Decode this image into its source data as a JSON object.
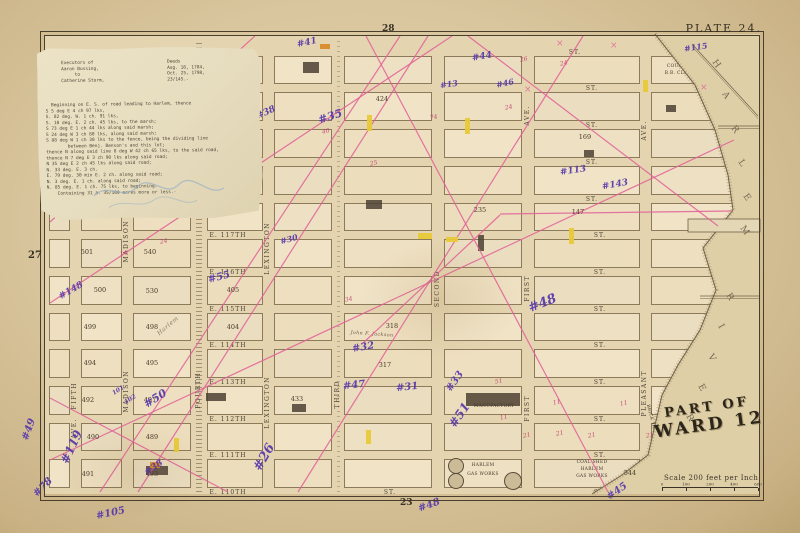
{
  "plate_label": "PLATE 24.",
  "margins": {
    "left": "27",
    "top": "28",
    "bottom": "23"
  },
  "ward_title": {
    "line1": "PART OF",
    "line2": "WARD 12"
  },
  "scale": {
    "label": "Scale 200 feet per Inch",
    "ticks": [
      "0",
      "100",
      "200",
      "400",
      "600"
    ]
  },
  "river": {
    "upper_letters": "HARLEM",
    "lower_letters": "RIVER"
  },
  "colors": {
    "paper": "#d9c69e",
    "block": "#eee0c2",
    "pink_line": "#e25f98",
    "purple_ink": "#5636ab",
    "red_ink": "#c23b6e",
    "yellow_lot": "#e8c938",
    "water": "#decfa7"
  },
  "deed_note": {
    "parties": [
      "Executors of",
      "Aaron Bussing,",
      "     to",
      "Catherine Storm,"
    ],
    "deeds": [
      "Deeds",
      "Aug. 18, 1784,",
      "Oct. 25, 1798,",
      "23/145.-"
    ],
    "body": [
      "  Beginning on E. S. of road leading to Harlem, thence",
      "S 5 deg E 4 ch 97 lks,",
      "S. 82 deg. W. 1 ch. 91 lks,",
      "S. 10 deg. E. 2 ch. 45 lks, to the marsh;",
      "S 73 deg E 1 ch 44 lks along said marsh;",
      "S 24 deg W 3 ch 80 lks, along said marsh;",
      "S 88 deg W 1 ch 30 lks to the fence, being the dividing line",
      "        between Benj. Benson's and this lot;",
      "thence N along said line 8 deg W 42 ch 65 lks, to the said road,",
      "thence N 7 deg E 3 ch 90 lks along said road;",
      "N 35 deg E 2 ch 45 lks along said road;",
      "N. 33 deg. E. 3 ch.",
      "E. 79 deg. 30 min E. 2 ch. along said road;",
      "N. 3 deg. E. 1 ch. along said road;",
      "N. 85 deg. E. 1 ch. 75 lks, to beginning.",
      "    Containing 31 a. 35/100 acres more or less.-"
    ]
  },
  "avenues": [
    {
      "x": 75,
      "w": 9,
      "labels": [
        {
          "t": "FIFTH",
          "y": 412
        },
        {
          "t": "AVE.",
          "y": 448
        }
      ]
    },
    {
      "x": 127,
      "w": 9,
      "labels": [
        {
          "t": "MADISON",
          "y": 250
        },
        {
          "t": "MADISON",
          "y": 400
        }
      ]
    },
    {
      "x": 199,
      "w": 14,
      "rail": true,
      "labels": [
        {
          "t": "FOURTH",
          "y": 402
        }
      ]
    },
    {
      "x": 268,
      "w": 9,
      "labels": [
        {
          "t": "LEXINGTON",
          "y": 252
        },
        {
          "t": "LEXINGTON",
          "y": 406
        }
      ]
    },
    {
      "x": 338,
      "w": 10,
      "el": true,
      "labels": [
        {
          "t": "THIRD",
          "y": 410
        }
      ]
    },
    {
      "x": 438,
      "w": 10,
      "labels": [
        {
          "t": "SECOND",
          "y": 300
        }
      ]
    },
    {
      "x": 528,
      "w": 10,
      "labels": [
        {
          "t": "FIRST",
          "y": 305
        },
        {
          "t": "AVE.",
          "y": 135
        },
        {
          "t": "FIRST",
          "y": 425
        }
      ]
    },
    {
      "x": 645,
      "w": 9,
      "labels": [
        {
          "t": "PLEASANT",
          "y": 400
        },
        {
          "t": "AVE.",
          "y": 150
        }
      ]
    }
  ],
  "streets": {
    "ys": [
      52,
      88,
      125,
      162,
      199,
      235,
      272,
      309,
      345,
      382,
      419,
      455,
      492
    ],
    "labels": [
      {
        "x": 228,
        "y": 235,
        "t": "E. 117TH"
      },
      {
        "x": 228,
        "y": 272,
        "t": "E. 116TH"
      },
      {
        "x": 228,
        "y": 309,
        "t": "E. 115TH"
      },
      {
        "x": 228,
        "y": 345,
        "t": "E. 114TH"
      },
      {
        "x": 228,
        "y": 382,
        "t": "E. 113TH"
      },
      {
        "x": 228,
        "y": 419,
        "t": "E. 112TH"
      },
      {
        "x": 228,
        "y": 455,
        "t": "E. 111TH"
      },
      {
        "x": 228,
        "y": 492,
        "t": "E. 110TH"
      },
      {
        "x": 600,
        "y": 235,
        "t": "ST."
      },
      {
        "x": 600,
        "y": 272,
        "t": "ST."
      },
      {
        "x": 600,
        "y": 309,
        "t": "ST."
      },
      {
        "x": 600,
        "y": 345,
        "t": "ST."
      },
      {
        "x": 600,
        "y": 382,
        "t": "ST."
      },
      {
        "x": 600,
        "y": 419,
        "t": "ST."
      },
      {
        "x": 600,
        "y": 455,
        "t": "ST."
      },
      {
        "x": 600,
        "y": 492,
        "t": "ST."
      },
      {
        "x": 592,
        "y": 88,
        "t": "ST."
      },
      {
        "x": 592,
        "y": 125,
        "t": "ST."
      },
      {
        "x": 592,
        "y": 162,
        "t": "ST."
      },
      {
        "x": 592,
        "y": 199,
        "t": "ST."
      },
      {
        "x": 575,
        "y": 52,
        "t": "ST."
      },
      {
        "x": 390,
        "y": 492,
        "t": "ST."
      }
    ]
  },
  "block_numbers": [
    {
      "x": 87,
      "y": 252,
      "t": "501"
    },
    {
      "x": 150,
      "y": 252,
      "t": "540"
    },
    {
      "x": 100,
      "y": 290,
      "t": "500"
    },
    {
      "x": 152,
      "y": 291,
      "t": "530"
    },
    {
      "x": 90,
      "y": 327,
      "t": "499"
    },
    {
      "x": 152,
      "y": 327,
      "t": "498"
    },
    {
      "x": 90,
      "y": 363,
      "t": "494"
    },
    {
      "x": 152,
      "y": 363,
      "t": "495"
    },
    {
      "x": 88,
      "y": 400,
      "t": "492"
    },
    {
      "x": 150,
      "y": 400,
      "t": "497"
    },
    {
      "x": 93,
      "y": 437,
      "t": "490"
    },
    {
      "x": 152,
      "y": 437,
      "t": "489"
    },
    {
      "x": 88,
      "y": 474,
      "t": "491"
    },
    {
      "x": 152,
      "y": 474,
      "t": "493"
    },
    {
      "x": 233,
      "y": 290,
      "t": "405"
    },
    {
      "x": 233,
      "y": 327,
      "t": "404"
    },
    {
      "x": 297,
      "y": 399,
      "t": "433"
    },
    {
      "x": 392,
      "y": 326,
      "t": "318"
    },
    {
      "x": 385,
      "y": 365,
      "t": "317"
    },
    {
      "x": 382,
      "y": 99,
      "t": "424"
    },
    {
      "x": 585,
      "y": 137,
      "t": "169"
    },
    {
      "x": 480,
      "y": 210,
      "t": "235"
    },
    {
      "x": 578,
      "y": 212,
      "t": "147"
    },
    {
      "x": 630,
      "y": 473,
      "t": "544"
    }
  ],
  "purple_notes": [
    {
      "x": 297,
      "y": 38,
      "t": "#41",
      "r": -12,
      "s": 9
    },
    {
      "x": 472,
      "y": 52,
      "t": "#44",
      "r": -10,
      "s": 9
    },
    {
      "x": 684,
      "y": 42,
      "t": "#115",
      "r": -8,
      "s": 8
    },
    {
      "x": 496,
      "y": 78,
      "t": "#46",
      "r": -12,
      "s": 8
    },
    {
      "x": 440,
      "y": 79,
      "t": "#13",
      "r": -8,
      "s": 8
    },
    {
      "x": 560,
      "y": 166,
      "t": "#113",
      "r": -8,
      "s": 9
    },
    {
      "x": 602,
      "y": 180,
      "t": "#143",
      "r": -10,
      "s": 9
    },
    {
      "x": 256,
      "y": 108,
      "t": "#38",
      "r": -25,
      "s": 9
    },
    {
      "x": 318,
      "y": 110,
      "t": "#35",
      "r": -18,
      "s": 11
    },
    {
      "x": 208,
      "y": 272,
      "t": "#55",
      "r": -15,
      "s": 10
    },
    {
      "x": 58,
      "y": 286,
      "t": "#148",
      "r": -30,
      "s": 9
    },
    {
      "x": 280,
      "y": 234,
      "t": "#30",
      "r": -15,
      "s": 8
    },
    {
      "x": 528,
      "y": 296,
      "t": "#48",
      "r": -22,
      "s": 13
    },
    {
      "x": 444,
      "y": 376,
      "t": "#33",
      "r": -55,
      "s": 10
    },
    {
      "x": 446,
      "y": 408,
      "t": "#51",
      "r": -55,
      "s": 12
    },
    {
      "x": 352,
      "y": 342,
      "t": "#32",
      "r": -10,
      "s": 10
    },
    {
      "x": 343,
      "y": 380,
      "t": "#47",
      "r": -6,
      "s": 10
    },
    {
      "x": 396,
      "y": 382,
      "t": "#31",
      "r": -6,
      "s": 10
    },
    {
      "x": 54,
      "y": 440,
      "t": "#119",
      "r": -65,
      "s": 12
    },
    {
      "x": 143,
      "y": 392,
      "t": "#50",
      "r": -32,
      "s": 11
    },
    {
      "x": 112,
      "y": 387,
      "t": "101",
      "r": -32,
      "s": 6
    },
    {
      "x": 124,
      "y": 396,
      "t": "102",
      "r": -32,
      "s": 6
    },
    {
      "x": 250,
      "y": 450,
      "t": "#26",
      "r": -60,
      "s": 13
    },
    {
      "x": 32,
      "y": 482,
      "t": "#78",
      "r": -45,
      "s": 10
    },
    {
      "x": 96,
      "y": 508,
      "t": "#105",
      "r": -12,
      "s": 10
    },
    {
      "x": 144,
      "y": 463,
      "t": "#38",
      "r": -35,
      "s": 9
    },
    {
      "x": 18,
      "y": 424,
      "t": "#49",
      "r": -70,
      "s": 10
    },
    {
      "x": 606,
      "y": 486,
      "t": "#45",
      "r": -35,
      "s": 10
    },
    {
      "x": 418,
      "y": 500,
      "t": "#48",
      "r": -20,
      "s": 10
    }
  ],
  "red_notes": [
    {
      "x": 160,
      "y": 238,
      "t": "24"
    },
    {
      "x": 120,
      "y": 250,
      "t": "14"
    },
    {
      "x": 345,
      "y": 296,
      "t": "34"
    },
    {
      "x": 505,
      "y": 104,
      "t": "24"
    },
    {
      "x": 520,
      "y": 56,
      "t": "26"
    },
    {
      "x": 560,
      "y": 60,
      "t": "24"
    },
    {
      "x": 430,
      "y": 114,
      "t": "74"
    },
    {
      "x": 495,
      "y": 378,
      "t": "51"
    },
    {
      "x": 523,
      "y": 432,
      "t": "21"
    },
    {
      "x": 556,
      "y": 430,
      "t": "21"
    },
    {
      "x": 588,
      "y": 432,
      "t": "21"
    },
    {
      "x": 646,
      "y": 432,
      "t": "21"
    },
    {
      "x": 620,
      "y": 400,
      "t": "11"
    },
    {
      "x": 553,
      "y": 399,
      "t": "11"
    },
    {
      "x": 500,
      "y": 414,
      "t": "11"
    },
    {
      "x": 370,
      "y": 160,
      "t": "25"
    },
    {
      "x": 322,
      "y": 128,
      "t": "40"
    }
  ],
  "pink_x_marks": [
    {
      "x": 556,
      "y": 46
    },
    {
      "x": 610,
      "y": 48
    },
    {
      "x": 700,
      "y": 90
    },
    {
      "x": 524,
      "y": 92
    }
  ],
  "yellow_lots": [
    {
      "x": 367,
      "y": 115,
      "w": 5,
      "h": 16
    },
    {
      "x": 465,
      "y": 118,
      "w": 5,
      "h": 16
    },
    {
      "x": 569,
      "y": 228,
      "w": 5,
      "h": 16
    },
    {
      "x": 418,
      "y": 233,
      "w": 14,
      "h": 6
    },
    {
      "x": 446,
      "y": 237,
      "w": 12,
      "h": 5
    },
    {
      "x": 174,
      "y": 438,
      "w": 5,
      "h": 14
    },
    {
      "x": 366,
      "y": 430,
      "w": 5,
      "h": 14
    },
    {
      "x": 643,
      "y": 80,
      "w": 5,
      "h": 12
    },
    {
      "x": 150,
      "y": 462,
      "w": 10,
      "h": 6,
      "c": "#d88a2a"
    },
    {
      "x": 320,
      "y": 44,
      "w": 10,
      "h": 5,
      "c": "#d88a2a"
    }
  ],
  "pink_lines": [
    {
      "x1": 50,
      "y1": 222,
      "x2": 255,
      "y2": 36
    },
    {
      "x1": 50,
      "y1": 303,
      "x2": 452,
      "y2": 36
    },
    {
      "x1": 100,
      "y1": 492,
      "x2": 400,
      "y2": 36
    },
    {
      "x1": 138,
      "y1": 492,
      "x2": 428,
      "y2": 36
    },
    {
      "x1": 50,
      "y1": 460,
      "x2": 734,
      "y2": 140
    },
    {
      "x1": 298,
      "y1": 492,
      "x2": 583,
      "y2": 36
    },
    {
      "x1": 366,
      "y1": 36,
      "x2": 608,
      "y2": 492
    },
    {
      "x1": 468,
      "y1": 36,
      "x2": 718,
      "y2": 226
    },
    {
      "x1": 500,
      "y1": 214,
      "x2": 732,
      "y2": 211
    },
    {
      "x1": 500,
      "y1": 215,
      "x2": 362,
      "y2": 344
    },
    {
      "x1": 50,
      "y1": 398,
      "x2": 228,
      "y2": 492
    }
  ],
  "landmarks": {
    "gas_works": {
      "line1": "HARLEM",
      "line2": "GAS WORKS",
      "x": 483,
      "y": 470,
      "tanks": [
        [
          455,
          465,
          7
        ],
        [
          455,
          480,
          7
        ],
        [
          512,
          480,
          8
        ]
      ]
    },
    "coal_shed": {
      "lines": [
        "COAL SHED",
        "HARLEM",
        "GAS WORKS"
      ],
      "x": 592,
      "y": 462
    },
    "manufactory": {
      "label": "MANUFACTORY",
      "x": 494,
      "y": 406,
      "rect": [
        466,
        393,
        54,
        13
      ]
    },
    "club": {
      "lines": [
        "COUNTY",
        "B.B. CLUB"
      ],
      "x": 678,
      "y": 66
    },
    "brick_yard": {
      "label": "BRICK YARD",
      "x": 652,
      "y": 420,
      "r": 75
    },
    "harlem_road": {
      "label": "Harlem",
      "x": 168,
      "y": 326,
      "r": -40
    },
    "jackson": {
      "label": "John F. Jackson",
      "x": 372,
      "y": 334,
      "r": 4
    },
    "dark_buildings": [
      [
        303,
        62,
        16,
        11
      ],
      [
        292,
        404,
        14,
        8
      ],
      [
        584,
        150,
        10,
        7
      ],
      [
        666,
        105,
        10,
        7
      ],
      [
        478,
        235,
        6,
        16
      ],
      [
        146,
        466,
        22,
        9
      ],
      [
        206,
        393,
        20,
        8
      ],
      [
        366,
        200,
        16,
        9
      ]
    ]
  },
  "river_geometry": {
    "water_poly": "655,34 695,85 715,130 728,175 733,210 703,248 716,290 700,330 678,365 662,395 655,425 648,455 622,475 592,494 760,494 760,34",
    "shore_line": "655,34 695,85 715,130 728,175 733,210 703,248 716,290 700,330 678,365 662,395 655,425 648,455 622,475 592,494",
    "piers": [
      [
        688,
        219,
        72,
        13
      ]
    ],
    "bulkheads": [
      [
        718,
        126,
        760,
        126
      ],
      [
        700,
        296,
        760,
        296
      ],
      [
        692,
        44,
        758,
        116
      ]
    ],
    "upper_letter_pts": [
      [
        712,
        62
      ],
      [
        722,
        94
      ],
      [
        731,
        128
      ],
      [
        738,
        162
      ],
      [
        743,
        196
      ],
      [
        740,
        228
      ]
    ],
    "lower_letter_pts": [
      [
        726,
        295
      ],
      [
        718,
        326
      ],
      [
        708,
        356
      ],
      [
        698,
        386
      ],
      [
        686,
        416
      ]
    ]
  }
}
